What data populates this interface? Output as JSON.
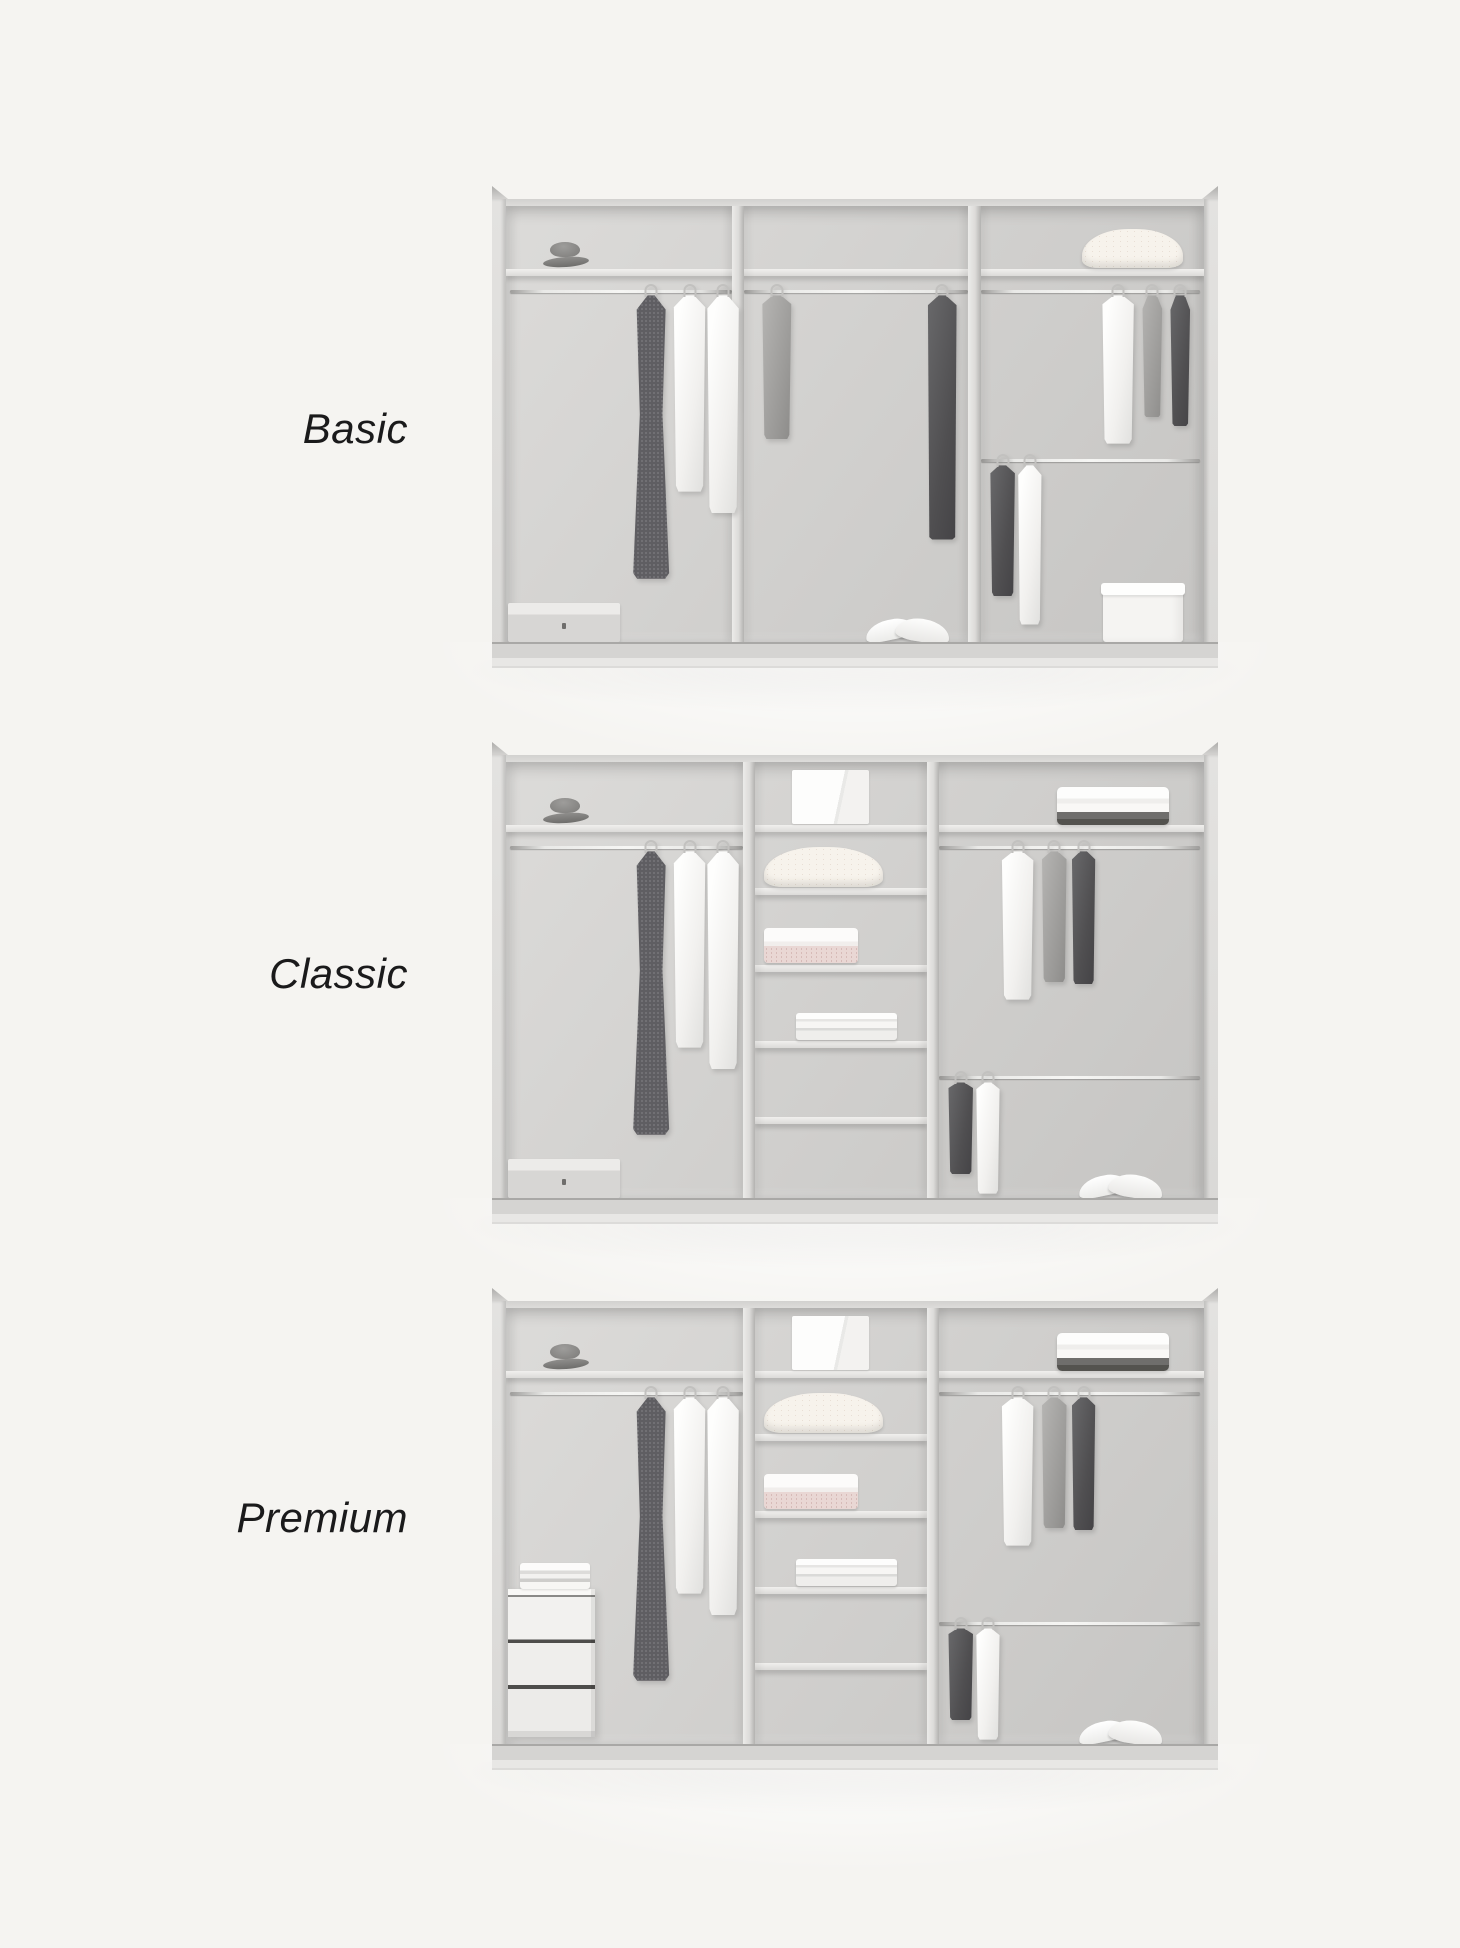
{
  "colors": {
    "page_background": "#f5f4f1",
    "label_text": "#1a1a1b",
    "wardrobe_frame": "#dddcda",
    "wardrobe_interior": "#cfcecc",
    "shelf": "#e9e8e6",
    "rail_chrome": "#f2f2f0",
    "garment_white": "#fafaf9",
    "garment_gray": "#9c9b99",
    "garment_dark": "#4f4f51",
    "blanket_cream": "#f7f3ec",
    "linen_pink": "#e9d7d4"
  },
  "tiers": [
    {
      "id": "basic",
      "label": "Basic",
      "layout": {
        "label_top": 403,
        "wardrobe_top": 186
      },
      "wardrobe": {
        "dividers": [
          {
            "x": 32.4,
            "w": 1.7
          },
          {
            "x": 66.2,
            "w": 1.8
          }
        ],
        "shelves": [
          {
            "name": "top-shelf",
            "x1": 0,
            "x2": 100,
            "y": 14.5
          }
        ],
        "rails": [
          {
            "name": "rail-left",
            "x1": 0.6,
            "x2": 32.4,
            "y": 19.2
          },
          {
            "name": "rail-middle",
            "x1": 34.1,
            "x2": 66.2,
            "y": 19.2
          },
          {
            "name": "rail-right-top",
            "x1": 68,
            "x2": 99.4,
            "y": 19.2
          },
          {
            "name": "rail-right-lower",
            "x1": 68,
            "x2": 99.4,
            "y": 58
          }
        ],
        "items": [
          {
            "name": "gray-hat",
            "kind": "hat",
            "x": 5.3,
            "y": 8.2,
            "w": 6.6,
            "h": 5.8
          },
          {
            "name": "folded-blanket",
            "kind": "blanket",
            "x": 82.5,
            "y": 5.2,
            "w": 14.5,
            "h": 9
          },
          {
            "name": "patterned-dress",
            "kind": "garment",
            "variant": "pattern",
            "shape": "dress",
            "x": 18,
            "y": 20.5,
            "w": 5.6,
            "h": 65
          },
          {
            "name": "white-shirt",
            "kind": "garment",
            "variant": "white",
            "shape": "shirt",
            "x": 23.8,
            "y": 20.5,
            "w": 5,
            "h": 45
          },
          {
            "name": "white-shirt",
            "kind": "garment",
            "variant": "white",
            "shape": "shirt",
            "x": 28.6,
            "y": 20.5,
            "w": 5,
            "h": 50
          },
          {
            "name": "gray-cardigan",
            "kind": "garment",
            "variant": "gray",
            "shape": "shirt",
            "x": 36.5,
            "y": 20.5,
            "w": 4.6,
            "h": 33
          },
          {
            "name": "dark-coat",
            "kind": "garment",
            "variant": "dark",
            "shape": "coat",
            "x": 60,
            "y": 20.5,
            "w": 5,
            "h": 56
          },
          {
            "name": "white-shirt",
            "kind": "garment",
            "variant": "white",
            "shape": "shirt",
            "x": 85.2,
            "y": 20.5,
            "w": 5,
            "h": 34
          },
          {
            "name": "gray-tank-top",
            "kind": "garment",
            "variant": "gray",
            "shape": "tank",
            "x": 90.8,
            "y": 20.5,
            "w": 3.6,
            "h": 28
          },
          {
            "name": "dark-top",
            "kind": "garment",
            "variant": "dark",
            "shape": "tank",
            "x": 94.8,
            "y": 20.5,
            "w": 3.6,
            "h": 30
          },
          {
            "name": "dark-shirt",
            "kind": "garment",
            "variant": "dark",
            "shape": "shirt",
            "x": 69.2,
            "y": 59.5,
            "w": 3.9,
            "h": 30
          },
          {
            "name": "white-shirt",
            "kind": "garment",
            "variant": "white",
            "shape": "shirt",
            "x": 73.2,
            "y": 59.5,
            "w": 3.7,
            "h": 36.5
          },
          {
            "name": "flat-storage-box",
            "kind": "box-flat",
            "x": 0.3,
            "y": 91,
            "w": 16,
            "h": 9
          },
          {
            "name": "white-sneakers",
            "kind": "sneakers",
            "x": 51.5,
            "y": 93.5,
            "w": 12,
            "h": 6.5
          },
          {
            "name": "white-storage-box",
            "kind": "box-white",
            "x": 85.5,
            "y": 86.5,
            "w": 11.5,
            "h": 13.5
          }
        ]
      }
    },
    {
      "id": "classic",
      "label": "Classic",
      "layout": {
        "label_top": 948,
        "wardrobe_top": 742
      },
      "wardrobe": {
        "dividers": [
          {
            "x": 34,
            "w": 1.7
          },
          {
            "x": 60.3,
            "w": 1.7
          }
        ],
        "shelves": [
          {
            "name": "top-shelf",
            "x1": 0,
            "x2": 100,
            "y": 14.5
          },
          {
            "name": "middle-shelf-1",
            "x1": 35.7,
            "x2": 60.3,
            "y": 29
          },
          {
            "name": "middle-shelf-2",
            "x1": 35.7,
            "x2": 60.3,
            "y": 46.5
          },
          {
            "name": "middle-shelf-3",
            "x1": 35.7,
            "x2": 60.3,
            "y": 64
          },
          {
            "name": "middle-shelf-4",
            "x1": 35.7,
            "x2": 60.3,
            "y": 81.5
          }
        ],
        "rails": [
          {
            "name": "rail-left",
            "x1": 0.6,
            "x2": 34,
            "y": 19.2
          },
          {
            "name": "rail-right-top",
            "x1": 62,
            "x2": 99.4,
            "y": 19.2
          },
          {
            "name": "rail-right-lower",
            "x1": 62,
            "x2": 99.4,
            "y": 72
          }
        ],
        "items": [
          {
            "name": "gray-hat",
            "kind": "hat",
            "x": 5.3,
            "y": 8.2,
            "w": 6.6,
            "h": 5.8
          },
          {
            "name": "white-box",
            "kind": "box-top",
            "x": 41,
            "y": 1.8,
            "w": 11,
            "h": 12.5
          },
          {
            "name": "folded-clothes-stack",
            "kind": "stack-top",
            "x": 79,
            "y": 5.8,
            "w": 16,
            "h": 8.6
          },
          {
            "name": "patterned-dress",
            "kind": "garment",
            "variant": "pattern",
            "shape": "dress",
            "x": 18,
            "y": 20.5,
            "w": 5.6,
            "h": 65
          },
          {
            "name": "white-shirt",
            "kind": "garment",
            "variant": "white",
            "shape": "shirt",
            "x": 23.8,
            "y": 20.5,
            "w": 5,
            "h": 45
          },
          {
            "name": "white-shirt",
            "kind": "garment",
            "variant": "white",
            "shape": "shirt",
            "x": 28.6,
            "y": 20.5,
            "w": 5,
            "h": 50
          },
          {
            "name": "folded-blanket",
            "kind": "blanket",
            "x": 37,
            "y": 19.5,
            "w": 17,
            "h": 9.2
          },
          {
            "name": "folded-linen-stack",
            "kind": "stack-pink",
            "x": 37,
            "y": 38,
            "w": 13.5,
            "h": 8.2
          },
          {
            "name": "folded-shirts-stack",
            "kind": "shirts-stack",
            "x": 41.5,
            "y": 57.5,
            "w": 14.5,
            "h": 6.2
          },
          {
            "name": "white-shirt",
            "kind": "garment",
            "variant": "white",
            "shape": "shirt",
            "x": 70.8,
            "y": 20.5,
            "w": 5,
            "h": 34
          },
          {
            "name": "gray-shirt",
            "kind": "garment",
            "variant": "gray",
            "shape": "shirt",
            "x": 76.6,
            "y": 20.5,
            "w": 3.9,
            "h": 30
          },
          {
            "name": "dark-shirt",
            "kind": "garment",
            "variant": "dark",
            "shape": "shirt",
            "x": 80.9,
            "y": 20.5,
            "w": 3.7,
            "h": 30.5
          },
          {
            "name": "dark-shirt",
            "kind": "garment",
            "variant": "dark",
            "shape": "shirt",
            "x": 63.2,
            "y": 73.5,
            "w": 3.9,
            "h": 21
          },
          {
            "name": "white-shirt",
            "kind": "garment",
            "variant": "white",
            "shape": "shirt",
            "x": 67.2,
            "y": 73.5,
            "w": 3.7,
            "h": 25.5
          },
          {
            "name": "flat-storage-box",
            "kind": "box-flat",
            "x": 0.3,
            "y": 91,
            "w": 16,
            "h": 9
          },
          {
            "name": "white-sneakers",
            "kind": "sneakers",
            "x": 82,
            "y": 93.5,
            "w": 12,
            "h": 6.5
          }
        ]
      }
    },
    {
      "id": "premium",
      "label": "Premium",
      "layout": {
        "label_top": 1492,
        "wardrobe_top": 1288
      },
      "wardrobe": {
        "dividers": [
          {
            "x": 34,
            "w": 1.7
          },
          {
            "x": 60.3,
            "w": 1.7
          }
        ],
        "shelves": [
          {
            "name": "top-shelf",
            "x1": 0,
            "x2": 100,
            "y": 14.5
          },
          {
            "name": "middle-shelf-1",
            "x1": 35.7,
            "x2": 60.3,
            "y": 29
          },
          {
            "name": "middle-shelf-2",
            "x1": 35.7,
            "x2": 60.3,
            "y": 46.5
          },
          {
            "name": "middle-shelf-3",
            "x1": 35.7,
            "x2": 60.3,
            "y": 64
          },
          {
            "name": "middle-shelf-4",
            "x1": 35.7,
            "x2": 60.3,
            "y": 81.5
          }
        ],
        "rails": [
          {
            "name": "rail-left",
            "x1": 0.6,
            "x2": 34,
            "y": 19.2
          },
          {
            "name": "rail-right-top",
            "x1": 62,
            "x2": 99.4,
            "y": 19.2
          },
          {
            "name": "rail-right-lower",
            "x1": 62,
            "x2": 99.4,
            "y": 72
          }
        ],
        "items": [
          {
            "name": "gray-hat",
            "kind": "hat",
            "x": 5.3,
            "y": 8.2,
            "w": 6.6,
            "h": 5.8
          },
          {
            "name": "white-box",
            "kind": "box-top",
            "x": 41,
            "y": 1.8,
            "w": 11,
            "h": 12.5
          },
          {
            "name": "folded-clothes-stack",
            "kind": "stack-top",
            "x": 79,
            "y": 5.8,
            "w": 16,
            "h": 8.6
          },
          {
            "name": "patterned-dress",
            "kind": "garment",
            "variant": "pattern",
            "shape": "dress",
            "x": 18,
            "y": 20.5,
            "w": 5.6,
            "h": 65
          },
          {
            "name": "white-shirt",
            "kind": "garment",
            "variant": "white",
            "shape": "shirt",
            "x": 23.8,
            "y": 20.5,
            "w": 5,
            "h": 45
          },
          {
            "name": "white-shirt",
            "kind": "garment",
            "variant": "white",
            "shape": "shirt",
            "x": 28.6,
            "y": 20.5,
            "w": 5,
            "h": 50
          },
          {
            "name": "folded-blanket",
            "kind": "blanket",
            "x": 37,
            "y": 19.5,
            "w": 17,
            "h": 9.2
          },
          {
            "name": "folded-linen-stack",
            "kind": "stack-pink",
            "x": 37,
            "y": 38,
            "w": 13.5,
            "h": 8.2
          },
          {
            "name": "folded-shirts-stack",
            "kind": "shirts-stack",
            "x": 41.5,
            "y": 57.5,
            "w": 14.5,
            "h": 6.2
          },
          {
            "name": "white-shirt",
            "kind": "garment",
            "variant": "white",
            "shape": "shirt",
            "x": 70.8,
            "y": 20.5,
            "w": 5,
            "h": 34
          },
          {
            "name": "gray-shirt",
            "kind": "garment",
            "variant": "gray",
            "shape": "shirt",
            "x": 76.6,
            "y": 20.5,
            "w": 3.9,
            "h": 30
          },
          {
            "name": "dark-shirt",
            "kind": "garment",
            "variant": "dark",
            "shape": "shirt",
            "x": 80.9,
            "y": 20.5,
            "w": 3.7,
            "h": 30.5
          },
          {
            "name": "dark-shirt",
            "kind": "garment",
            "variant": "dark",
            "shape": "shirt",
            "x": 63.2,
            "y": 73.5,
            "w": 3.9,
            "h": 21
          },
          {
            "name": "white-shirt",
            "kind": "garment",
            "variant": "white",
            "shape": "shirt",
            "x": 67.2,
            "y": 73.5,
            "w": 3.7,
            "h": 25.5
          },
          {
            "name": "drawer-unit",
            "kind": "drawers",
            "x": 0.3,
            "y": 64.5,
            "w": 12.5,
            "h": 34
          },
          {
            "name": "folded-towels",
            "kind": "drawer-stack",
            "x": 2,
            "y": 58.5,
            "w": 10,
            "h": 6
          },
          {
            "name": "white-sneakers",
            "kind": "sneakers",
            "x": 82,
            "y": 93.5,
            "w": 12,
            "h": 6.5
          }
        ]
      }
    }
  ]
}
